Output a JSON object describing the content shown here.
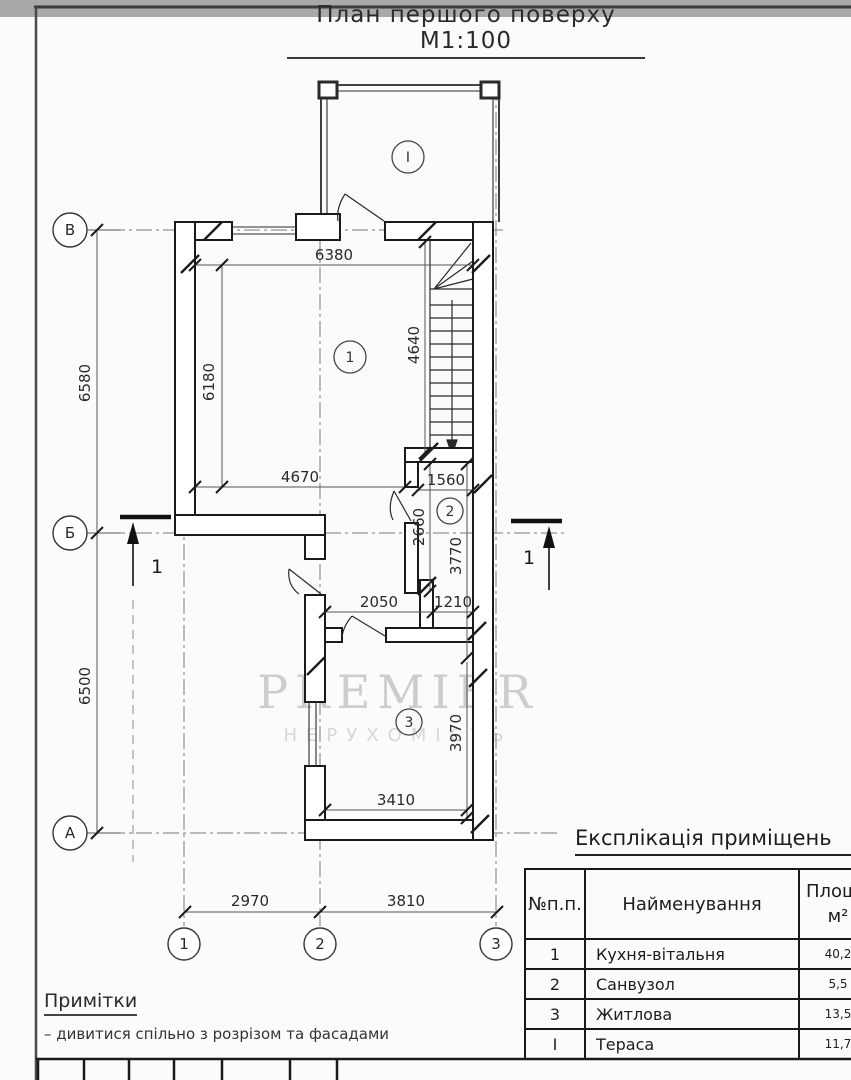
{
  "title": "План першого поверху М1:100",
  "watermark": {
    "line1": "PREMIER",
    "line2": "НЕРУХОМІСТЬ"
  },
  "plan": {
    "dims": {
      "d6380": "6380",
      "d4640": "4640",
      "d6180": "6180",
      "d4670": "4670",
      "d1560": "1560",
      "d2660": "2660",
      "d3770": "3770",
      "d2050": "2050",
      "d1210": "1210",
      "d3970": "3970",
      "d3410": "3410",
      "d6580": "6580",
      "d6500": "6500",
      "d2970": "2970",
      "d3810": "3810"
    },
    "axes": {
      "row_top": "В",
      "row_mid": "Б",
      "row_bottom": "А",
      "col1": "1",
      "col2": "2",
      "col3": "3"
    },
    "rooms": {
      "terrace": "I",
      "kitchen": "1",
      "bath": "2",
      "living": "3"
    },
    "section": {
      "label": "1"
    }
  },
  "explication": {
    "title": "Експлікація приміщень",
    "headers": {
      "num": "№п.п.",
      "name": "Найменування",
      "area_top": "Площа",
      "area_unit": "м²"
    },
    "rows": [
      {
        "num": "1",
        "name": "Кухня-вітальня",
        "area": "40,2"
      },
      {
        "num": "2",
        "name": "Санвузол",
        "area": "5,5"
      },
      {
        "num": "3",
        "name": "Житлова",
        "area": "13,5"
      },
      {
        "num": "I",
        "name": "Тераса",
        "area": "11,7"
      }
    ]
  },
  "notes": {
    "title": "Примітки",
    "items": [
      "– дивитися спільно з розрізом та фасадами"
    ]
  },
  "colors": {
    "ink": "#1a1a1a",
    "thin": "#555555",
    "axis": "#777777",
    "watermark": "#cccccc"
  }
}
